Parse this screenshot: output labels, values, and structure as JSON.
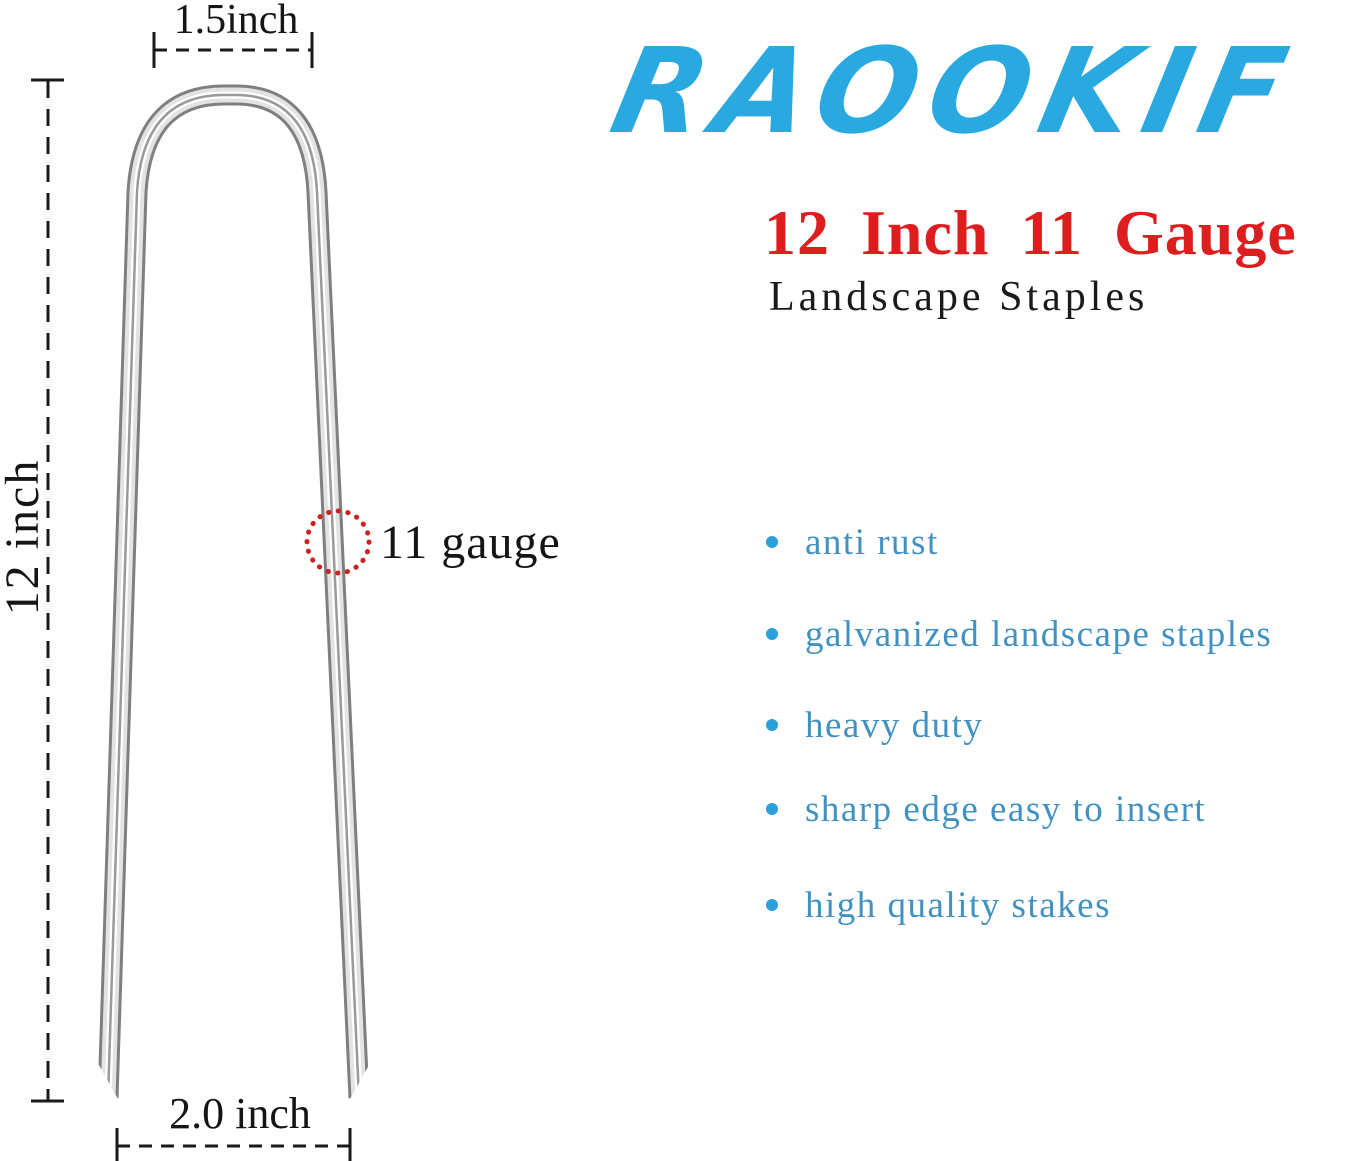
{
  "brand": {
    "name": "RAOOKIF",
    "color": "#2aa9e0"
  },
  "heading": {
    "title": "12 Inch 11 Gauge",
    "title_color": "#de1e1e",
    "subtitle": "Landscape Staples",
    "subtitle_color": "#1a1a1a"
  },
  "features": {
    "bullet_color": "#2c9fd9",
    "text_color": "#4191c1",
    "items": [
      "anti rust",
      "galvanized landscape staples",
      "heavy duty",
      "sharp edge easy to insert",
      "high quality stakes"
    ]
  },
  "diagram": {
    "labels": {
      "top_width": "1.5inch",
      "height": "12 inch",
      "gauge": "11 gauge",
      "bottom_width": "2.0 inch"
    },
    "gauge_circle_color": "#cc2222",
    "staple_finish": "galvanized-silver"
  }
}
